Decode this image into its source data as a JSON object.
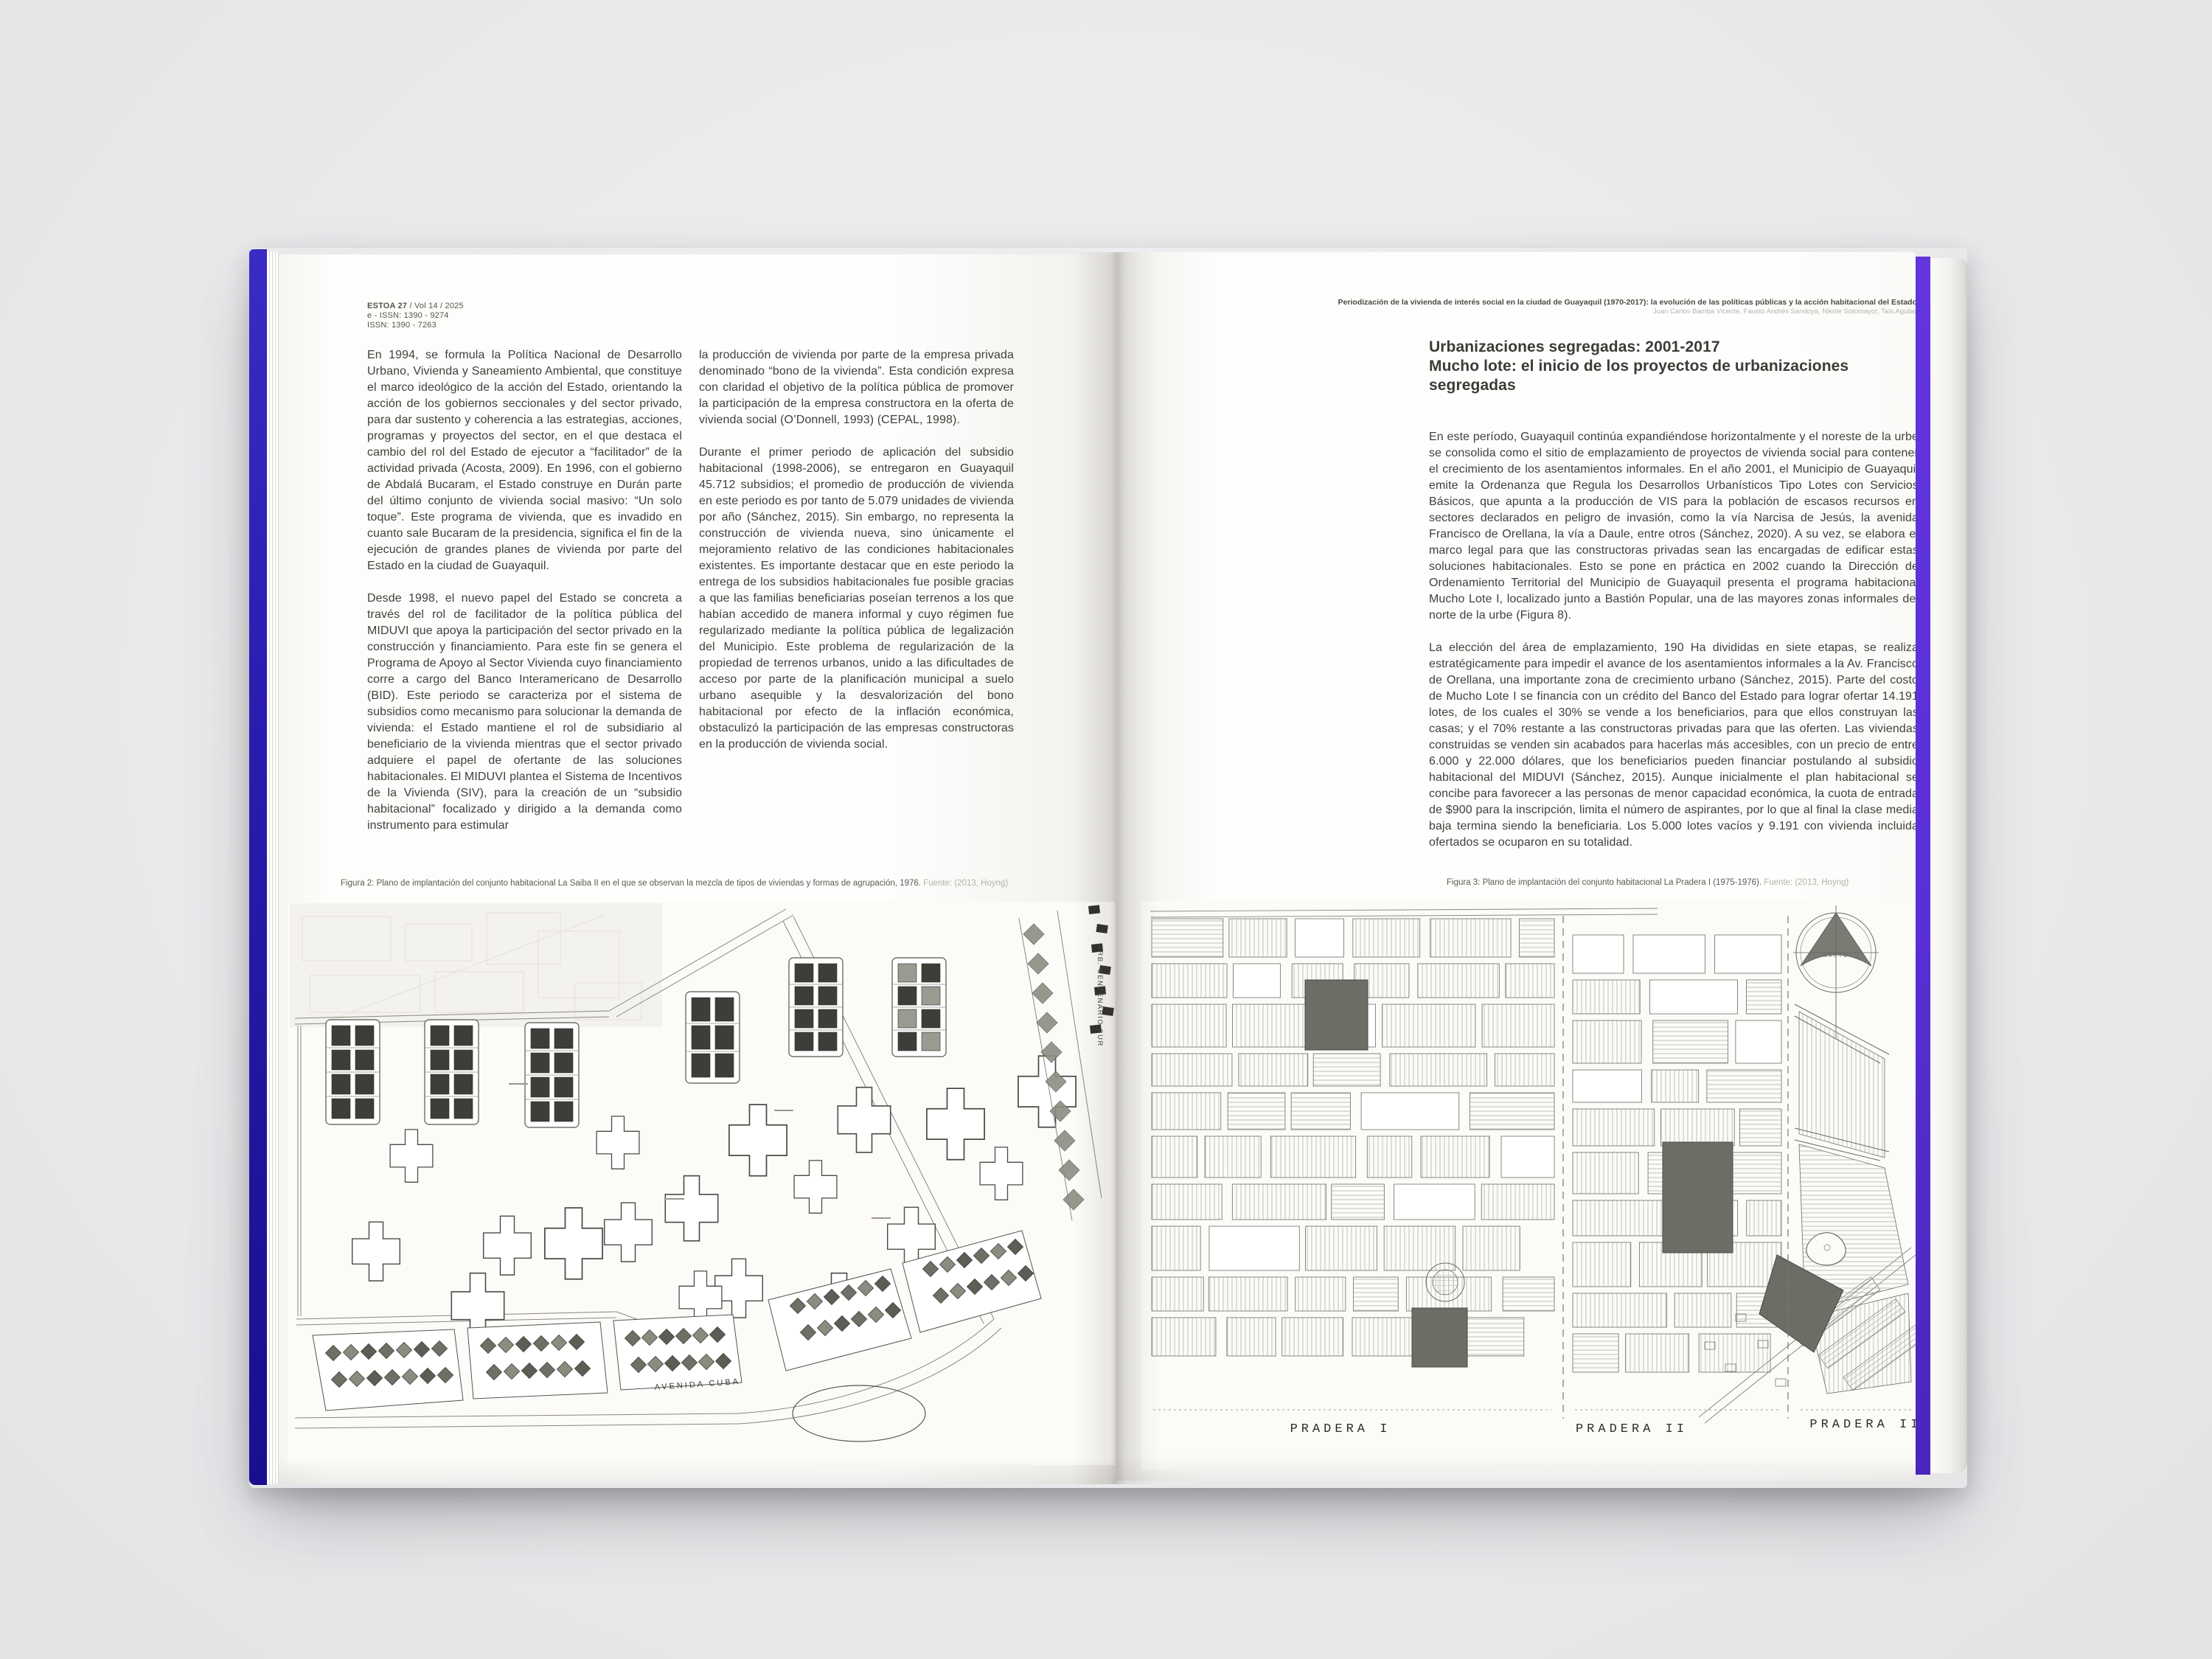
{
  "journal": {
    "name": "ESTOA 27",
    "volume": " / Vol 14 / 2025",
    "eissn": "e - ISSN: 1390 - 9274",
    "issn": "ISSN: 1390 - 7263"
  },
  "running_header": {
    "title": "Periodización de la vivienda de interés social en la ciudad de Guayaquil (1970-2017): la evolución de las políticas públicas y la acción habitacional del Estado",
    "authors": "Juan Carlos Bamba Vicente, Fausto Andrés Sandoya, Nikole Sotomayor, Taís Aguilar"
  },
  "left_page": {
    "col1_p1": "En 1994, se formula la Política Nacional de Desarrollo Urbano, Vivienda y Saneamiento Ambiental, que constituye el marco ideológico de la acción del Estado, orientando la acción de los gobiernos seccionales y del sector privado, para dar sustento y coherencia a las estrategias, acciones, programas y proyectos del sector, en el que destaca el cambio del rol del Estado de ejecutor a “facilitador” de la actividad privada (Acosta, 2009). En 1996, con el gobierno de Abdalá Bucaram, el Estado construye en Durán parte del último conjunto de vivienda social masivo: “Un solo toque”. Este programa de vivienda, que es invadido en cuanto sale Bucaram de la presidencia, significa el fin de la ejecución de grandes planes de vivienda por parte del Estado en la ciudad de Guayaquil.",
    "col1_p2": "Desde 1998, el nuevo papel del Estado se concreta a través del rol de facilitador de la política pública del MIDUVI que apoya la participación del sector privado en la construcción y financiamiento. Para este fin se genera el Programa de Apoyo al Sector Vivienda cuyo financiamiento corre a cargo del Banco Interamericano de Desarrollo (BID). Este periodo se caracteriza por el sistema de subsidios como mecanismo para solucionar la demanda de vivienda: el Estado mantiene el rol de subsidiario al beneficiario de la vivienda mientras que el sector privado adquiere el papel de ofertante de las soluciones habitacionales. El MIDUVI plantea el Sistema de Incentivos de la Vivienda (SIV), para la creación de un “subsidio habitacional” focalizado y dirigido a la demanda como instrumento para estimular",
    "col2_p1": "la producción de vivienda por parte de la empresa privada denominado “bono de la vivienda”. Esta condición expresa con claridad el objetivo de la política pública de promover la participación de la empresa constructora en la oferta de vivienda social (O’Donnell, 1993) (CEPAL, 1998).",
    "col2_p2": "Durante el primer periodo de aplicación del subsidio habitacional (1998-2006), se entregaron en Guayaquil 45.712 subsidios; el promedio de producción de vivienda en este periodo es por tanto de 5.079 unidades de vivienda por año (Sánchez, 2015). Sin embargo, no representa la construcción de vivienda nueva, sino únicamente el mejoramiento relativo de las condiciones habitacionales existentes. Es importante destacar que en este periodo la entrega de los subsidios habitacionales fue posible gracias a que las familias beneficiarias poseían terrenos a los que habían accedido de manera informal y cuyo régimen fue regularizado mediante la política pública de legalización del Municipio. Este problema de regularización de la propiedad de terrenos urbanos, unido a las dificultades de acceso por parte de la planificación municipal a suelo urbano asequible y la desvalorización del bono habitacional por efecto de la inflación económica, obstaculizó la participación de las empresas constructoras en la producción de vivienda social.",
    "figure_caption": {
      "text": "Figura 2: Plano de implantación del conjunto habitacional La Saiba II en el que se observan la mezcla de tipos de viviendas y formas de agrupación, 1976.",
      "source": " Fuente: (2013, Hoyng)"
    },
    "figure_labels": {
      "avenue": "AVENIDA CUBA",
      "district": "URB. CENTENARIO SUR"
    }
  },
  "right_page": {
    "section_title_line1": "Urbanizaciones segregadas: 2001-2017",
    "section_title_line2": "Mucho lote: el inicio de los proyectos de urbanizaciones segregadas",
    "p1": "En este período, Guayaquil continúa expandiéndose horizontalmente y el noreste de la urbe se consolida como el sitio de emplazamiento de proyectos de vivienda social para contener el crecimiento de los asentamientos informales. En el año 2001, el Municipio de Guayaquil emite la Ordenanza que Regula los Desarrollos Urbanísticos Tipo Lotes con Servicios Básicos, que apunta a la producción de VIS para la población de escasos recursos en sectores declarados en peligro de invasión, como la vía Narcisa de Jesús, la avenida Francisco de Orellana, la vía a Daule, entre otros (Sánchez, 2020). A su vez, se elabora el marco legal para que las constructoras privadas sean las encargadas de edificar estas soluciones habitacionales. Esto se pone en práctica en 2002 cuando la Dirección de Ordenamiento Territorial del Municipio de Guayaquil presenta el programa habitacional Mucho Lote I, localizado junto a Bastión Popular, una de las mayores zonas informales del norte de la urbe (Figura 8).",
    "p2": "La elección del área de emplazamiento, 190 Ha divididas en siete etapas, se realiza estratégicamente para impedir el avance de los asentamientos informales a la Av. Francisco de Orellana, una importante zona de crecimiento urbano (Sánchez, 2015). Parte del costo de Mucho Lote I se financia con un crédito del Banco del Estado para lograr ofertar 14.191 lotes, de los cuales el 30% se vende a los beneficiarios, para que ellos construyan las casas; y el 70% restante a las constructoras privadas para que las oferten. Las viviendas construidas se venden sin acabados para hacerlas más accesibles, con un precio de entre 6.000 y 22.000 dólares, que los beneficiarios pueden financiar postulando al subsidio habitacional del MIDUVI (Sánchez, 2015). Aunque inicialmente el plan habitacional se concibe para favorecer a las personas de menor capacidad económica, la cuota de entrada de $900 para la inscripción, limita el número de aspirantes, por lo que al final la clase media baja termina siendo la beneficiaria. Los 5.000 lotes vacíos y 9.191 con vivienda incluida ofertados se ocuparon en su totalidad.",
    "figure_caption": {
      "text": "Figura 3: Plano de implantación del conjunto habitacional La Pradera I (1975-1976).",
      "source": " Fuente: (2013, Hoyng)"
    },
    "figure_labels": {
      "pradera1": "PRADERA I",
      "pradera2": "PRADERA II",
      "pradera3": "PRADERA III",
      "north": "NORTE"
    }
  },
  "colors": {
    "spine_left_blue": "#2a1cae",
    "spine_right_purple": "#5a2fd4",
    "paper": "#fdfdfb",
    "ink": "#413f3c"
  }
}
